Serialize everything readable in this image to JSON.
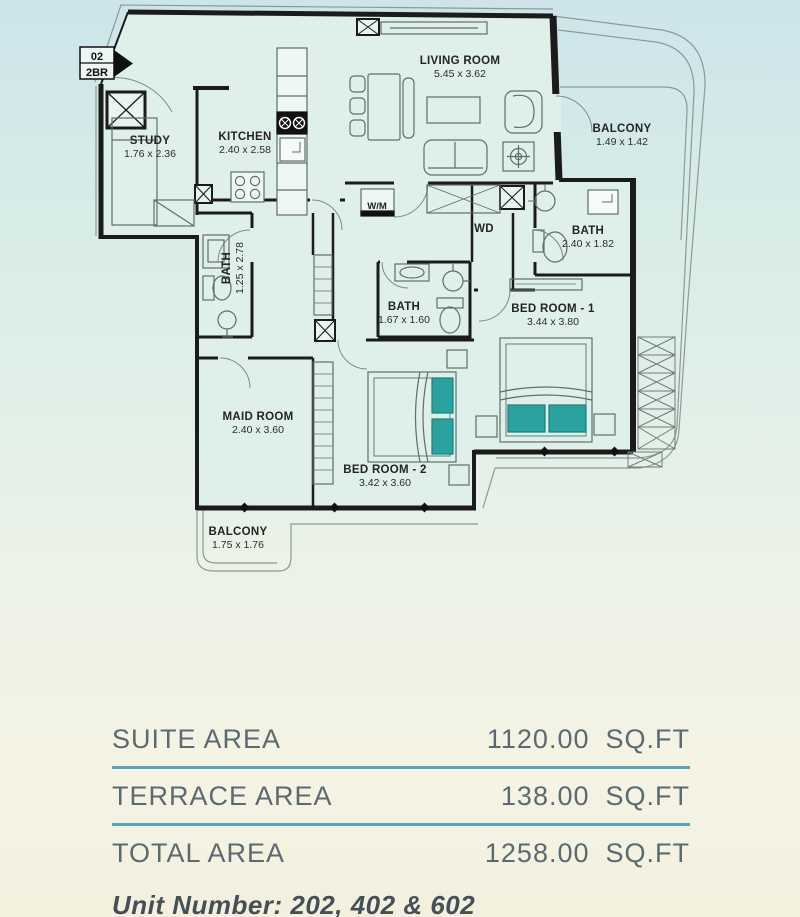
{
  "badge": {
    "number": "02",
    "type": "2BR"
  },
  "plan": {
    "rooms": [
      {
        "name": "STUDY",
        "dims": "1.76 x 2.36"
      },
      {
        "name": "KITCHEN",
        "dims": "2.40 x 2.58"
      },
      {
        "name": "LIVING ROOM",
        "dims": "5.45 x 3.62"
      },
      {
        "name": "BALCONY",
        "dims": "1.49 x 1.42"
      },
      {
        "name": "BATH",
        "dims": "1.25 x 2.78"
      },
      {
        "name": "BATH",
        "dims": "1.67 x 1.60"
      },
      {
        "name": "BATH",
        "dims": "2.40 x 1.82"
      },
      {
        "name": "BED ROOM - 1",
        "dims": "3.44 x 3.80"
      },
      {
        "name": "BED ROOM - 2",
        "dims": "3.42 x 3.60"
      },
      {
        "name": "MAID ROOM",
        "dims": "2.40 x 3.60"
      },
      {
        "name": "BALCONY",
        "dims": "1.75 x 1.76"
      }
    ],
    "appliances": {
      "washing_machine": "W/M",
      "dryer": "WD"
    }
  },
  "area_table": {
    "rows": [
      {
        "label": "SUITE AREA",
        "value": "1120.00",
        "unit": "SQ.FT"
      },
      {
        "label": "TERRACE AREA",
        "value": "138.00",
        "unit": "SQ.FT"
      },
      {
        "label": "TOTAL AREA",
        "value": "1258.00",
        "unit": "SQ.FT"
      }
    ],
    "unit_number": "Unit Number: 202, 402 & 602"
  },
  "colors": {
    "divider": "#54a4bd",
    "table_text": "#5b6a71",
    "accent_teal": "#2aa2a0",
    "wall": "#1b1b1b",
    "plan_fill": "#dff0ea"
  }
}
